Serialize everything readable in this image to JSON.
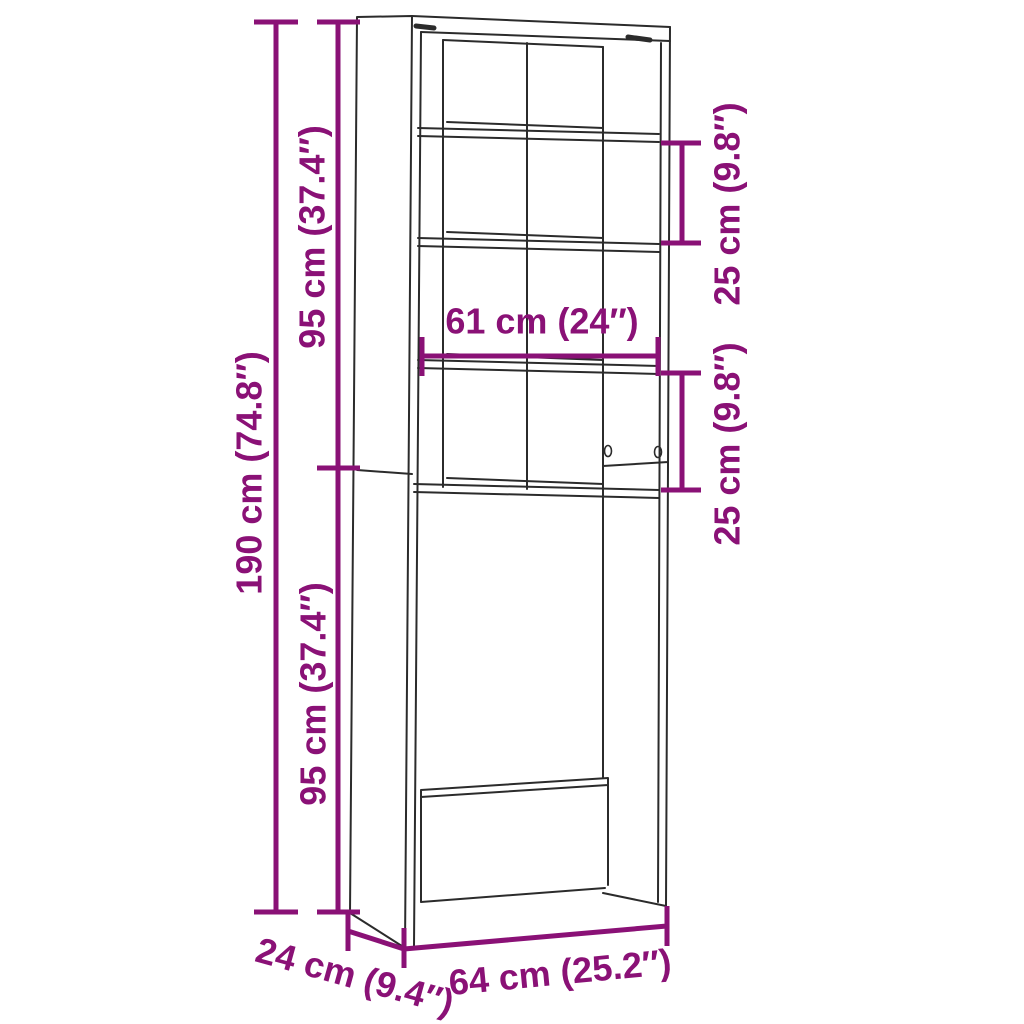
{
  "diagram": {
    "type": "furniture-dimension-diagram",
    "subject": "over-appliance bathroom storage cabinet with shelves",
    "background_color": "#ffffff",
    "line_color": "#2b2b2b",
    "dimension_color": "#8a1176",
    "dimensions": {
      "overall_height": "190 cm (74.8″)",
      "upper_section_height": "95 cm (37.4″)",
      "lower_section_height": "95 cm (37.4″)",
      "inner_width": "61 cm (24″)",
      "upper_shelf_spacing": "25 cm (9.8″)",
      "middle_shelf_spacing": "25 cm (9.8″)",
      "depth": "24 cm (9.4″)",
      "overall_width": "64 cm (25.2″)"
    }
  }
}
